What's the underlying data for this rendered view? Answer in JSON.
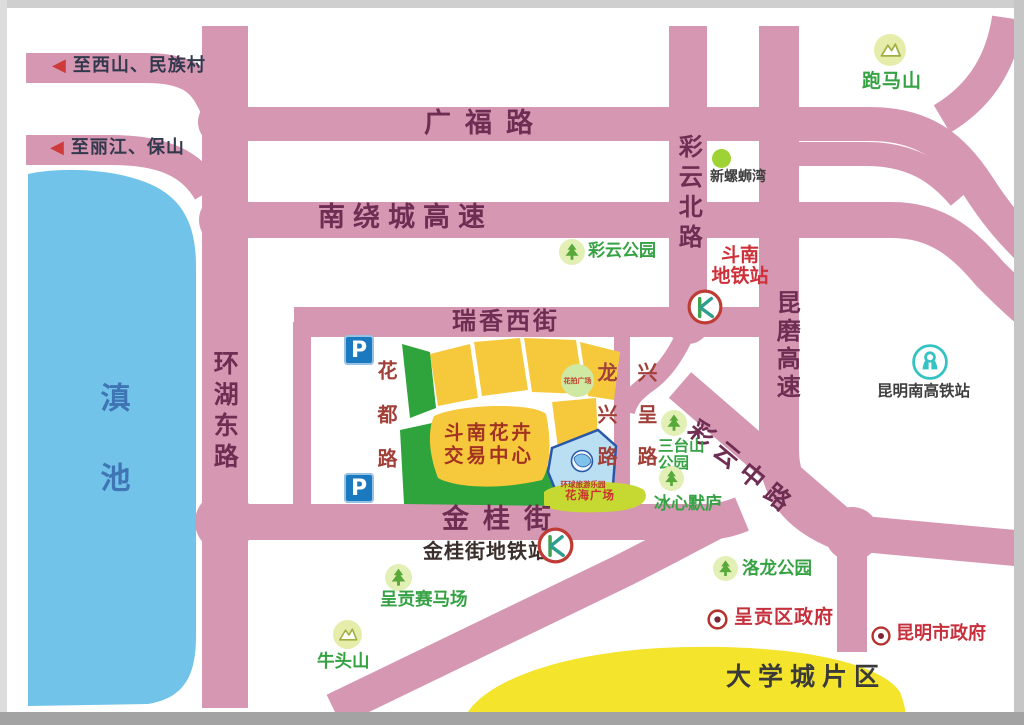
{
  "colors": {
    "road_pink": "#d697b2",
    "lake_blue": "#72c3e9",
    "market_yellow": "#f6c93d",
    "park_green": "#2fa43c",
    "dome_yellow": "#f4e42c",
    "road_label": "#6e2d52",
    "poi_green": "#35a244",
    "poi_red": "#c5303c",
    "inner_street_red": "#a04038",
    "lake_text_blue": "#3f74b5",
    "parking_blue": "#1b79c0"
  },
  "icons": {
    "exit_arrow": "◀",
    "metro": "kunming-metro-K",
    "railway": "china-railway-emblem",
    "park": "pine-tree",
    "mountain": "mountain-peak",
    "government": "bullseye",
    "parking_letter": "P"
  },
  "lake": {
    "name": "滇池"
  },
  "exits": {
    "xishan": "至西山、民族村",
    "lijiang": "至丽江、保山"
  },
  "roads": {
    "guangfu": "广福路",
    "nanrao": "南绕城高速",
    "huanhu": "环湖东路",
    "caiyun_north": "彩云北路",
    "kunmo": "昆磨高速",
    "ruixiang": "瑞香西街",
    "jingui": "金桂街",
    "caiyun_middle": "彩云中路",
    "huadu": "花都路",
    "longxing": "龙兴路",
    "xingcheng": "兴呈路"
  },
  "stations": {
    "dounan_metro_line1": "斗南",
    "dounan_metro_line2": "地铁站",
    "jingui_metro": "金桂街地铁站",
    "kunming_south": "昆明南高铁站"
  },
  "market": {
    "line1": "斗南花卉",
    "line2": "交易中心",
    "huapai_plaza": "花拍广场",
    "huahai_plaza": "花海广场",
    "resort_logo": "环球旅游乐园"
  },
  "pois": {
    "paomashan": "跑马山",
    "xinluosiwan": "新螺蛳湾",
    "caiyun_park": "彩云公园",
    "santaishan_line1": "三台山",
    "santaishan_line2": "公园",
    "bingxin": "冰心默庐",
    "luolong_park": "洛龙公园",
    "chenggong_gov": "呈贡区政府",
    "kunming_gov": "昆明市政府",
    "racecourse": "呈贡赛马场",
    "niutoushan": "牛头山",
    "university_town": "大学城片区"
  }
}
